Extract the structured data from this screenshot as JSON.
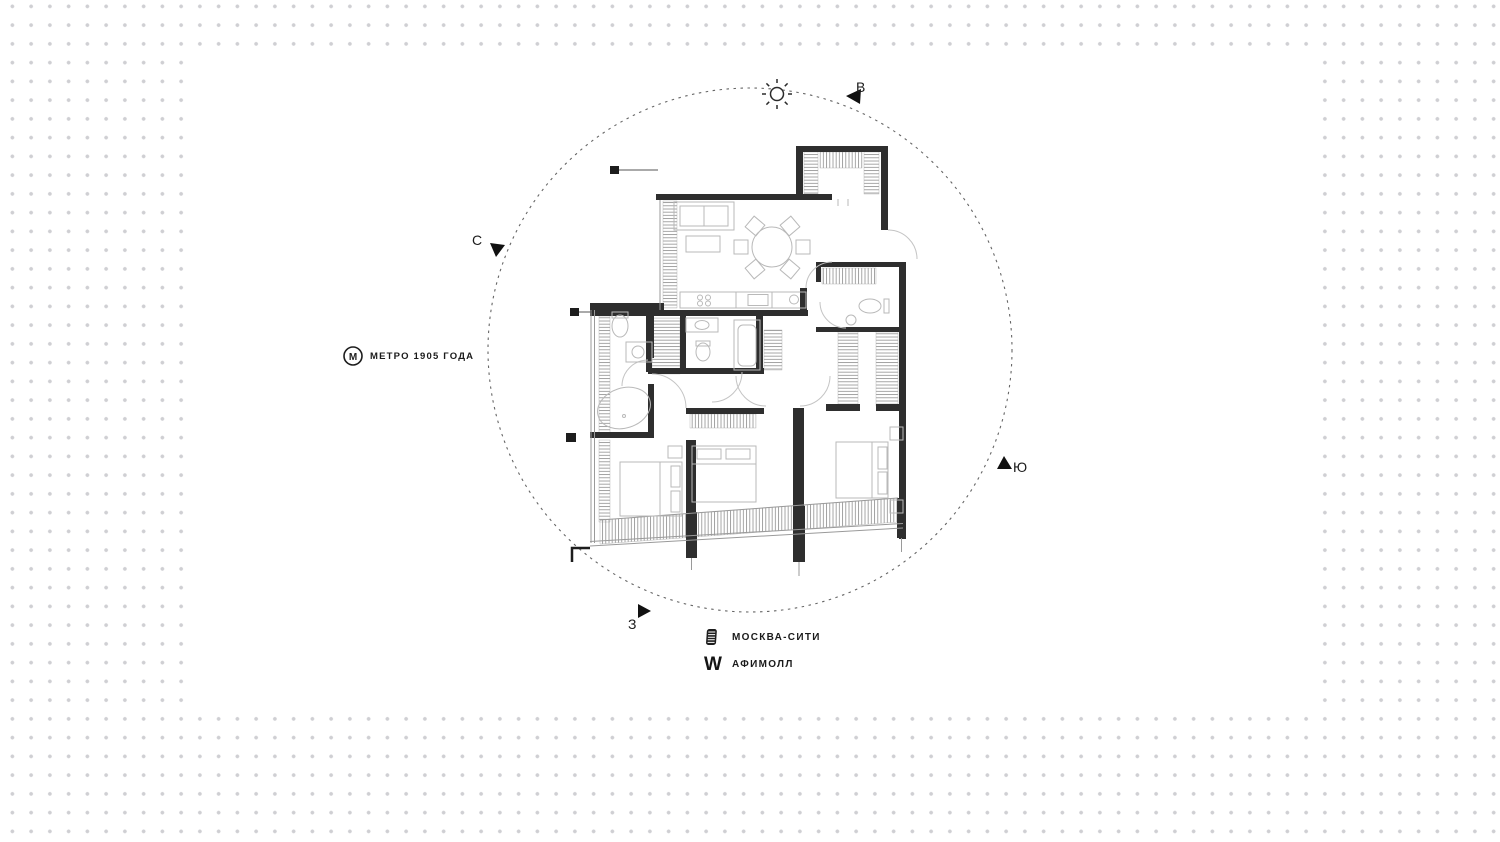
{
  "scene": {
    "compass": {
      "east": "В",
      "north": "С",
      "south": "Ю",
      "west": "З"
    },
    "landmarks": {
      "metro": {
        "icon_letter": "М",
        "label": "МЕТРО 1905 ГОДА"
      },
      "moscow_city": {
        "label": "МОСКВА-СИТИ"
      },
      "afimall": {
        "icon_glyph": "W",
        "label": "АФИМОЛЛ"
      }
    },
    "colors": {
      "background_dot": "#cfcfd3",
      "panel": "#ffffff",
      "wall": "#2e2e2e",
      "furniture_line": "#b9b9b9",
      "hatch_line": "#8f8f8f",
      "circle_dash": "#666666",
      "text": "#1b1b1b"
    },
    "floor_plan": {
      "type": "apartment-floor-plan",
      "orientation_circle": "dashed",
      "elements": [
        "entry-closet",
        "entry-door",
        "living-room",
        "sofa",
        "coffee-table",
        "dining-table-6-chairs",
        "kitchen-counter",
        "guest-wc",
        "bathroom-master",
        "bathroom-second",
        "oval-bathtub",
        "rect-bathtub",
        "wardrobes-hatched",
        "bedroom-1",
        "bedroom-2",
        "bedroom-3",
        "beds",
        "glazed-facade"
      ]
    }
  }
}
